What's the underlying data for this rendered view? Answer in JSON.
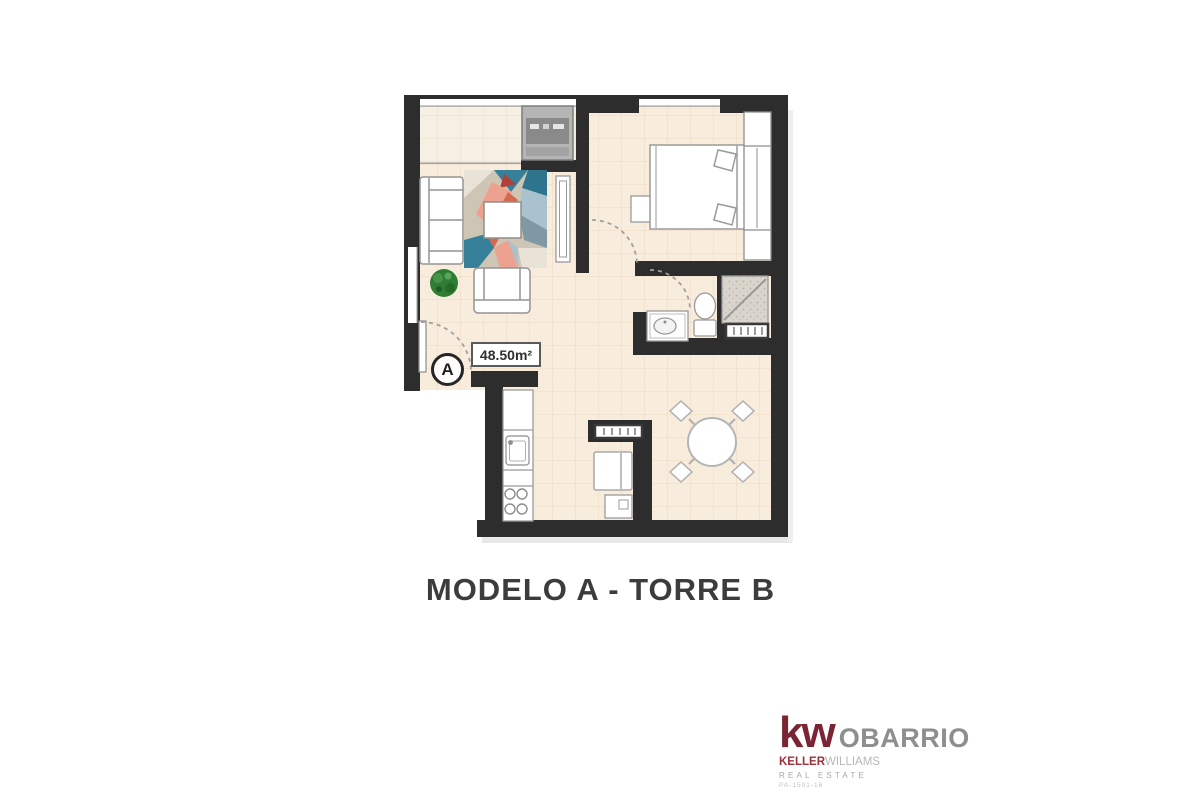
{
  "plan": {
    "title": "MODELO A - TORRE B",
    "area_label": "48.50m²",
    "unit_marker": "A"
  },
  "logo": {
    "mark": "kw",
    "office": "OBARRIO",
    "brand_first": "KELLER",
    "brand_second": "WILLIAMS",
    "tagline": "REAL ESTATE",
    "license": "PA-1501-16"
  },
  "colors": {
    "wall": "#2d2d2d",
    "floor": "#f8ecdc",
    "floor_grid": "#ecd9c1",
    "balcony_floor": "#f5efe4",
    "kw_red": "#7b2433",
    "keller_red": "#9c323c",
    "logo_gray": "#8e8e8e",
    "title_text": "#3c3c3c",
    "rug_teal": "#37809a",
    "rug_salmon": "#eda28f",
    "plant_green": "#2f7d33",
    "shower_gray": "#d9d4cc"
  }
}
